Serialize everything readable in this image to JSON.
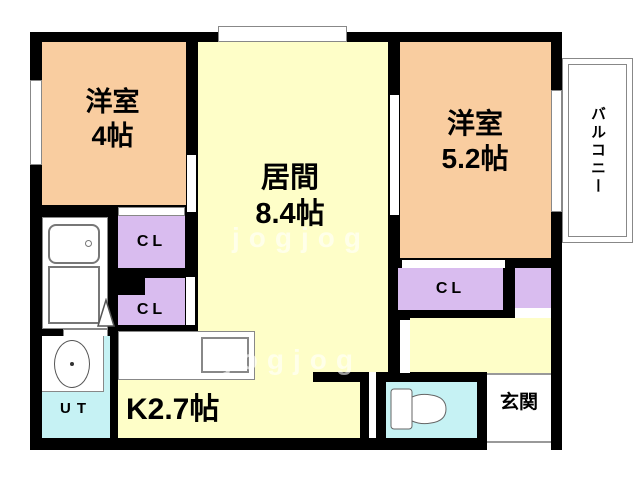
{
  "rooms": {
    "bedroom1": {
      "name": "洋室",
      "size": "4帖"
    },
    "living": {
      "name": "居間",
      "size": "8.4帖"
    },
    "bedroom2": {
      "name": "洋室",
      "size": "5.2帖"
    },
    "kitchen": {
      "label": "K2.7帖"
    },
    "utility": {
      "label": "UT"
    },
    "entrance": {
      "label": "玄関"
    },
    "balcony": {
      "label": "バルコニー"
    },
    "closet_upper_left": {
      "label": "CL"
    },
    "closet_lower_left": {
      "label": "CL"
    },
    "closet_right": {
      "label": "CL"
    }
  },
  "watermark": "jogjog",
  "colors": {
    "wall": "#000000",
    "western_room": "#F9CDA0",
    "living_kitchen": "#FEFEC8",
    "closet": "#D9BCEF",
    "wet_area": "#C6F2F4",
    "outline": "#808080"
  }
}
